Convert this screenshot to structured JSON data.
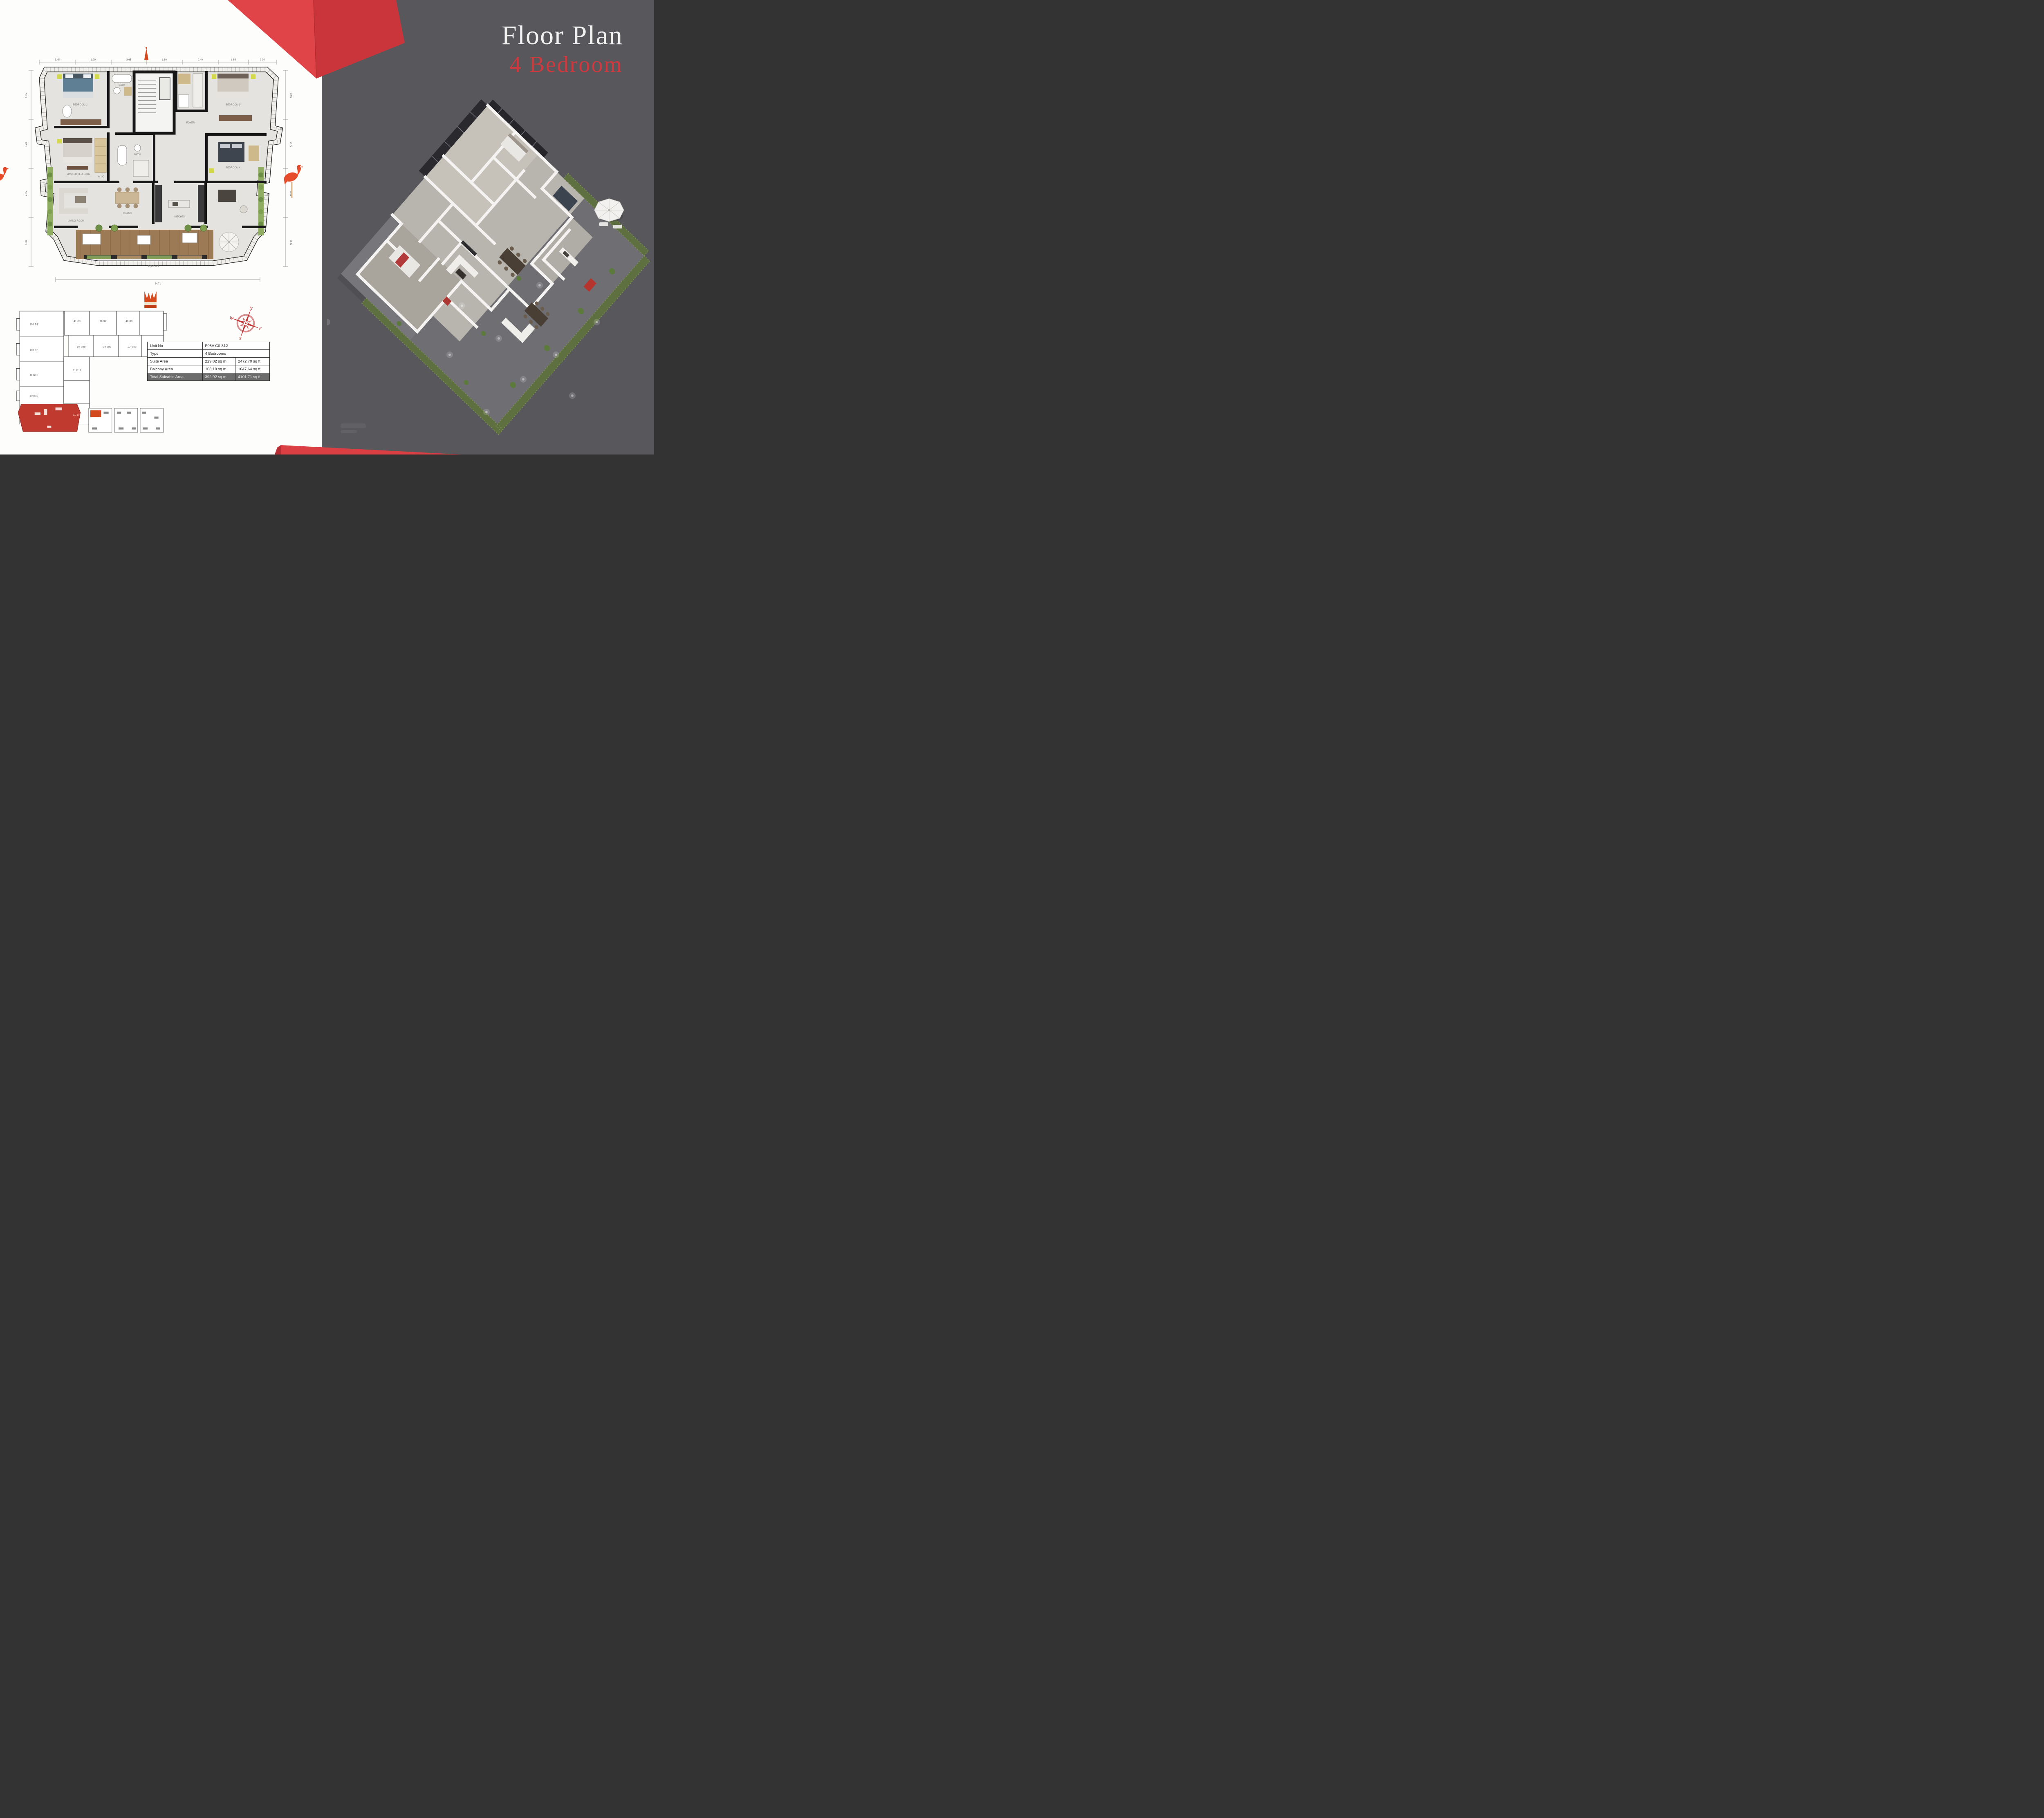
{
  "header": {
    "title": "Floor Plan",
    "subtitle": "4 Bedroom"
  },
  "colors": {
    "page_left_bg": "#fdfdfc",
    "page_right_bg": "#58585c",
    "accent_red": "#d8393f",
    "ribbon_red_light": "#e04348",
    "ribbon_red_dark": "#c9353b",
    "key_unit_red": "#c13a30",
    "crown_orange": "#d94a1e",
    "flamingo_red": "#e74c2c",
    "deck_wood": "#9c7a55",
    "plan_floor": "#e4e3df",
    "hedge_green": "#5f7040"
  },
  "unit_table": {
    "rows": {
      "unit_no": {
        "label": "Unit No",
        "value": "F08A C0-812"
      },
      "type": {
        "label": "Type",
        "value": "4 Bedrooms"
      },
      "suite": {
        "label": "Suite Area",
        "sqm": "229.82  sq m",
        "sqft": "2472.70  sq ft"
      },
      "balcony": {
        "label": "Balcony Area",
        "sqm": "163.10  sq m",
        "sqft": "1647.64  sq ft"
      },
      "total": {
        "label": "Total Saleable Area",
        "sqm": "392.92  sq m",
        "sqft": "4101.71  sq ft"
      }
    }
  },
  "compass": {
    "n": "N",
    "e": "E",
    "s": "S",
    "w": "W"
  },
  "floor_plan_2d": {
    "rooms": {
      "bedroom2": "BEDROOM 2",
      "bath1": "BATH",
      "foyer": "FOYER",
      "bedroom3": "BEDROOM 3",
      "master": "MASTER BEDROOM",
      "wic": "W.I.C",
      "bath2": "BATH",
      "bedroom4": "BEDROOM 4",
      "living": "LIVING ROOM",
      "dining": "DINING",
      "kitchen": "KITCHEN",
      "terrace": "TERRACE"
    },
    "dims": {
      "top": [
        "3.45",
        "1.20",
        "3.65",
        "1.80",
        "2.40",
        "1.65",
        "3.30"
      ],
      "bottom": "24.71",
      "left": [
        "4.05",
        "3.20",
        "2.85",
        "3.60"
      ],
      "right": [
        "3.95",
        "2.70",
        "3.15",
        "3.40"
      ]
    }
  },
  "key_plan": {
    "units": [
      "101 B1",
      "101 B2",
      "41-88",
      "B 888",
      "40-88",
      "B7 888",
      "B9 888",
      "10+888",
      "11 D10",
      "11 D11",
      "10 B10",
      "11 101"
    ]
  }
}
